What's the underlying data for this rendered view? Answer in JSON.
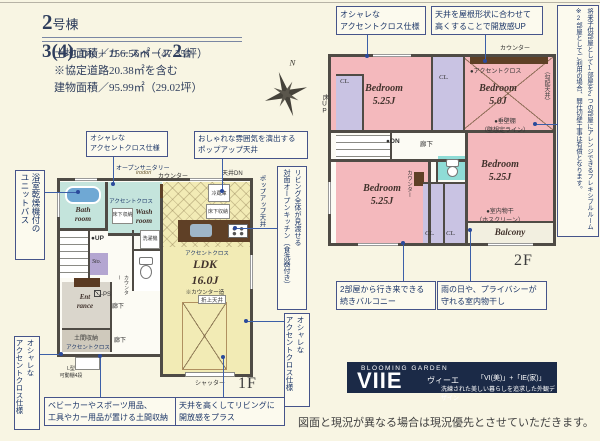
{
  "header": {
    "building_no": "2",
    "building_suffix": "号棟",
    "plan_main": "3",
    "plan_paren": "(4)",
    "plan_ldk": "LDK＋カースペース",
    "plan_cars": "2",
    "plan_cars_unit": "台",
    "land_area": "土地面積／156.56㎡（47.35坪）",
    "road_note": "※協定道路20.38㎡を含む",
    "building_area": "建物面積／95.99㎡（29.02坪）"
  },
  "compass": {
    "north": "N"
  },
  "callouts": {
    "accent_2f": "オシャレな\nアクセントクロス仕様",
    "roof_ceiling": "天井を屋根形状に合わせて\n高くすることで開放感UP",
    "flex_room": "将来子供部屋として1部屋を2つの部屋にアレンジできるフレキシブルルーム\n※2部屋としてご利用の場合、間仕切壁工事は有償となります。",
    "twin_balcony": "2部屋から行き来できる\n続きバルコニー",
    "indoor_drying": "雨の日や、プライバシーが\n守れる室内物干し",
    "unit_bath": "浴室乾燥機付の\nユニットバス",
    "accent_1f_top": "オシャレな\nアクセントクロス仕様",
    "popup_ceiling": "おしゃれな雰囲気を演出する\nポップアップ天井",
    "open_kitchen": "リビング全体が見渡せる\n対面オープンキッチン（食洗器付き）",
    "accent_1f_right": "オシャレな\nアクセントクロス仕様",
    "accent_1f_left": "オシャレな\nアクセントクロス仕様",
    "doma_storage": "ベビーカーやスポーツ用品、\n工具やカー用品が置ける土間収納",
    "high_ceiling": "天井を高くしてリビングに\n開放感をプラス"
  },
  "plan2f": {
    "floor_tag": "2F",
    "bedroom1_name": "Bedroom",
    "bedroom1_size": "5.25J",
    "bedroom2_name": "Bedroom",
    "bedroom2_size": "5.0J",
    "bedroom3_name": "Bedroom",
    "bedroom3_size": "5.25J",
    "bedroom4_name": "Bedroom",
    "bedroom4_size": "5.25J",
    "balcony": "Balcony",
    "closet": "CL.",
    "counter_top": "カウンター",
    "counter_side": "カウンター",
    "accent_cross": "●アクセントクロス",
    "sloped_ceiling": "（勾配天井）",
    "floor_up": "床UP",
    "stairs_on": "●ON",
    "hallway": "廊下",
    "hanging_wall": "●垂壁棚\n（壁想定ライン）",
    "indoor_drying": "●室内物干\n（ホスクリーン）"
  },
  "plan1f": {
    "floor_tag": "1F",
    "open_sanitary": "オープンサニタリー",
    "sanitary_brand": "irodori",
    "counter": "カウンター",
    "ceiling_dn": "天井DN",
    "popup_ceiling": "ポップアップ天井",
    "accent_cross_wash": "アクセントクロス",
    "accent_cross_ldk": "アクセントクロス",
    "accent_cross_doma": "アクセントクロス",
    "fridge": "冷蔵庫",
    "floor_storage1": "床下収納",
    "floor_storage2": "床下収納",
    "bath": "Bath\nroom",
    "wash": "Wash\nroom",
    "washer": "洗濯機",
    "stairs_up": "●UP",
    "storage": "Sto.",
    "ldk_name": "LDK",
    "ldk_size": "16.0J",
    "counter_note": "※カウンター造",
    "folded_ceiling": "折上天井",
    "entrance": "Ent\nrance",
    "doma": "土間収納",
    "hallway1": "廊下",
    "hallway2": "廊下",
    "counter_v": "カウンター",
    "ps": "PS",
    "l_shelf": "L型\n可動棚4段",
    "shutter": "シャッター"
  },
  "branding": {
    "brand": "BLOOMING GARDEN",
    "logo": "VIIE",
    "reading": "ヴィーエ",
    "formula": "「VI(美)」+「IE(家)」",
    "tagline": "洗練された美しい暮らしを追求した外観デザイン"
  },
  "footer": {
    "disclaimer": "図面と現況が異なる場合は現況優先とさせていただきます。"
  },
  "colors": {
    "background_cream": "#f8f5e3",
    "accent_navy": "#1c3668",
    "wall_gray": "#4f4b45",
    "room_pink": "#f4b9bd",
    "closet_lavender": "#c9c3e3",
    "bath_teal": "#c4e4dc",
    "toilet_cyan": "#8fdcd6",
    "ldk_yellow": "#f2ebb5",
    "storage_purple": "#b4a6d1",
    "counter_brown": "#5f4026",
    "brand_navy": "#1b2a47"
  }
}
